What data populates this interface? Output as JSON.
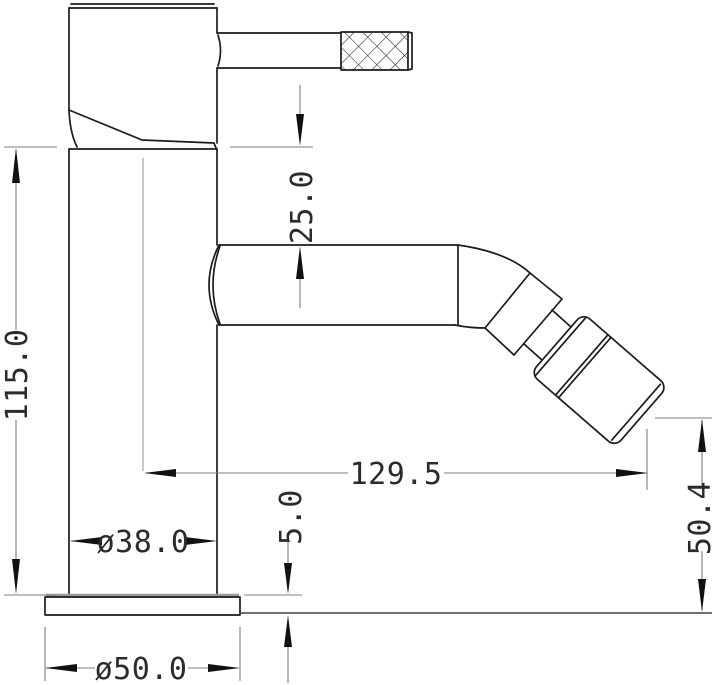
{
  "drawing": {
    "title": "bidet-mixer-tap-side-elevation",
    "type": "technical-dimension-drawing",
    "units": "mm",
    "background_color": "#ffffff",
    "object_line_color": "#1c1c1c",
    "dimension_line_color": "#7d7d7d",
    "text_color": "#2b2b2b",
    "features": {
      "knurl_pattern": "diamond-crosshatch",
      "views": "side elevation, single view"
    },
    "dimensions": {
      "handle_to_spout": {
        "label": "25.0",
        "value": 25.0,
        "orientation": "vertical",
        "measures": "body underside to top of spout"
      },
      "overall_height": {
        "label": "115.0",
        "value": 115.0,
        "orientation": "vertical",
        "measures": "column height above base plate"
      },
      "spout_reach": {
        "label": "129.5",
        "value": 129.5,
        "orientation": "horizontal",
        "measures": "body centerline to aerator outlet"
      },
      "base_thickness": {
        "label": "5.0",
        "value": 5.0,
        "orientation": "vertical",
        "measures": "base plate thickness"
      },
      "outlet_height": {
        "label": "50.4",
        "value": 50.4,
        "orientation": "vertical",
        "measures": "aerator outlet above mounting plane"
      },
      "body_diameter": {
        "label": "ø38.0",
        "value": 38.0,
        "orientation": "horizontal",
        "measures": "column diameter"
      },
      "base_diameter": {
        "label": "ø50.0",
        "value": 50.0,
        "orientation": "horizontal",
        "measures": "base plate diameter"
      }
    }
  }
}
